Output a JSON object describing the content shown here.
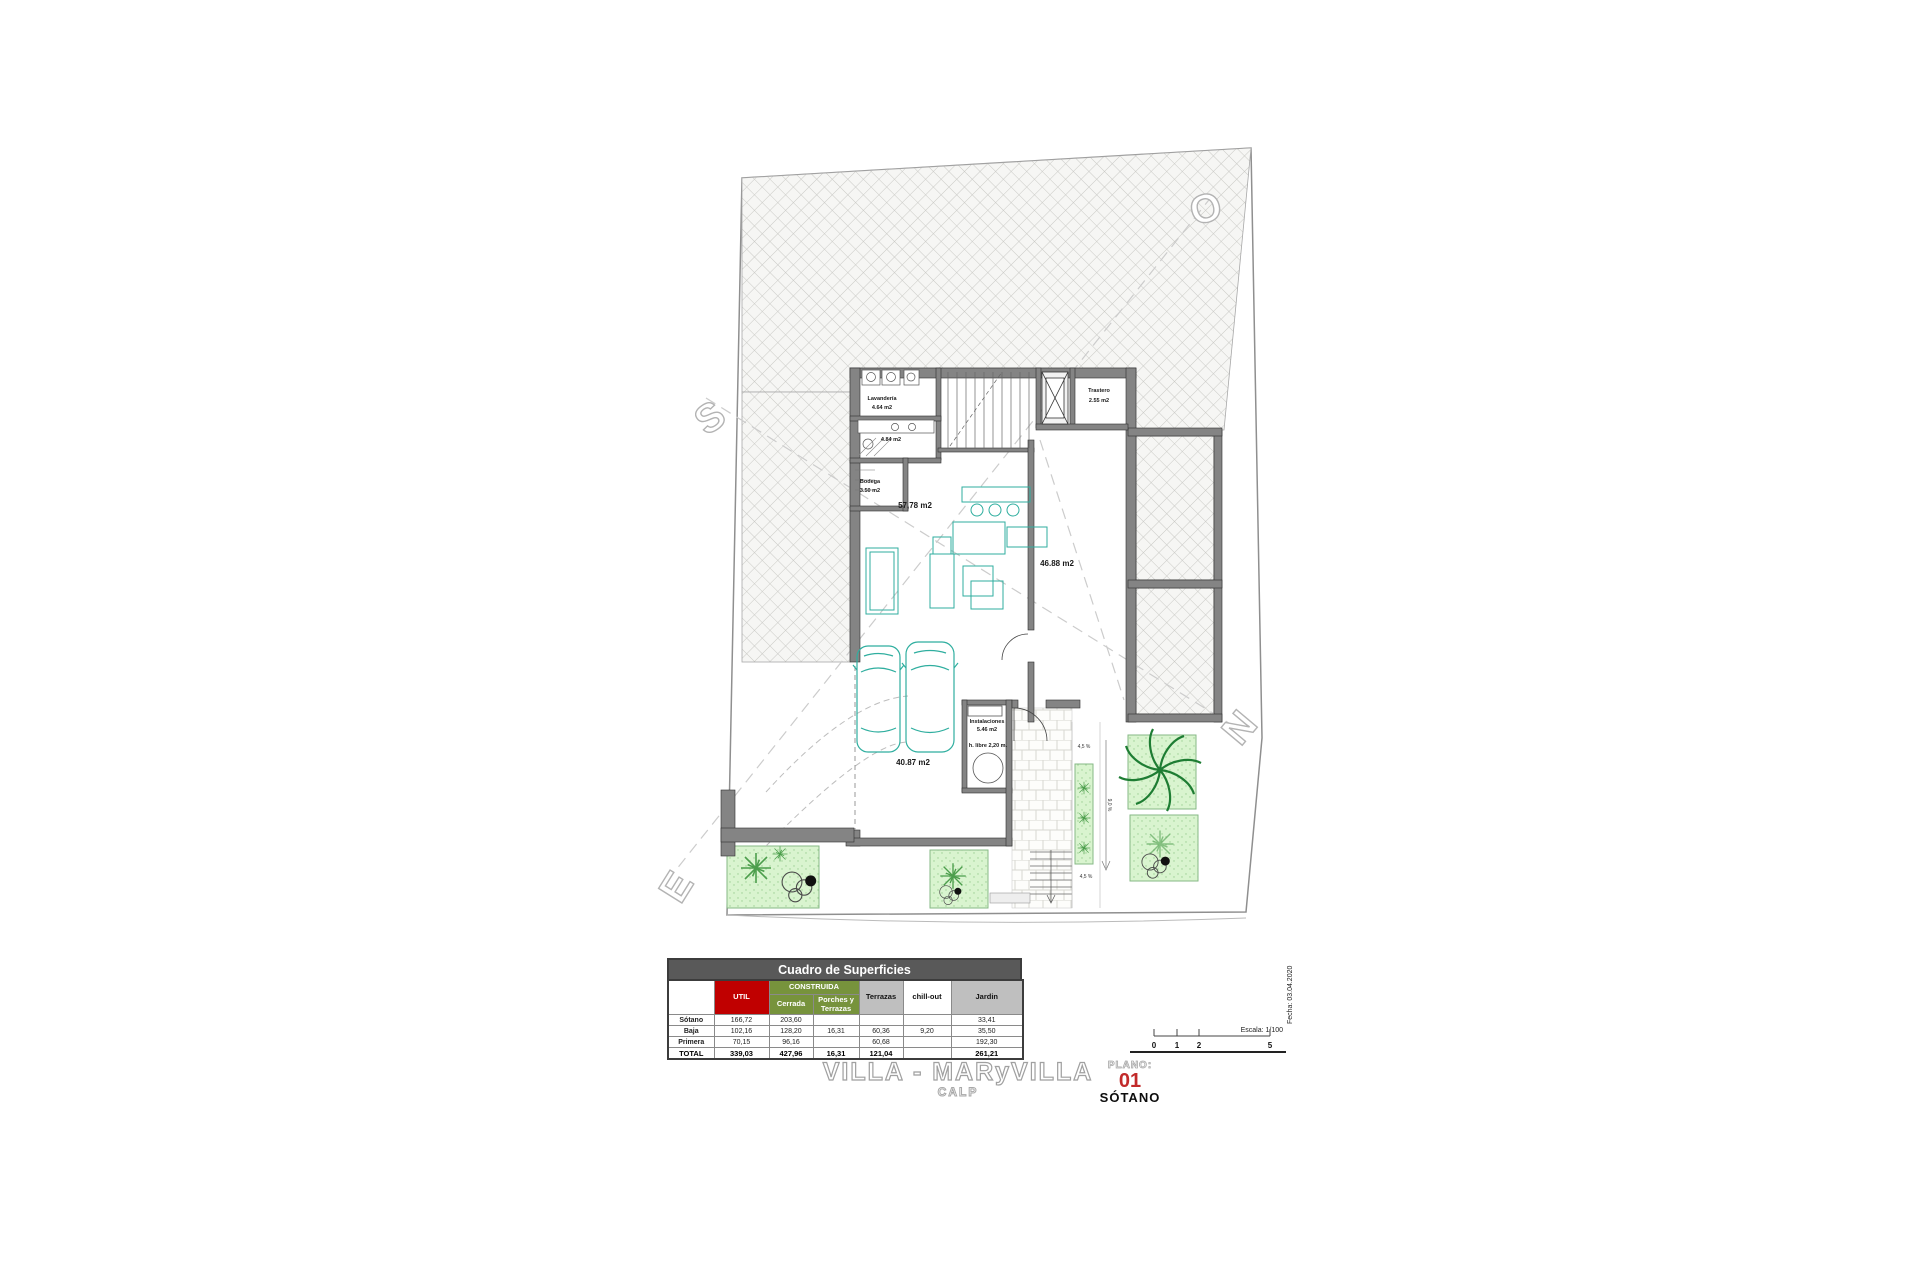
{
  "colors": {
    "accent_red": "#c00000",
    "accent_green": "#77933c",
    "header_dark_gray": "#595959",
    "header_light_gray": "#bfbfbf",
    "furniture_teal": "#2fae9f",
    "garden_green": "#d9f4cf",
    "plano_number_red": "#c22a2a"
  },
  "surfaces": {
    "title": "Cuadro de Superficies",
    "headers": {
      "util": "UTIL",
      "construida": "CONSTRUIDA",
      "cerrada": "Cerrada",
      "porches": "Porches y Terrazas",
      "terrazas": "Terrazas",
      "chill_out": "chill-out",
      "jardin": "Jardin"
    },
    "rows": [
      {
        "label": "Sótano",
        "cells": [
          "166,72",
          "203,60",
          "",
          "",
          "",
          "33,41"
        ]
      },
      {
        "label": "Baja",
        "cells": [
          "102,16",
          "128,20",
          "16,31",
          "60,36",
          "9,20",
          "35,50"
        ]
      },
      {
        "label": "Primera",
        "cells": [
          "70,15",
          "96,16",
          "",
          "60,68",
          "",
          "192,30"
        ]
      },
      {
        "label": "TOTAL",
        "cells": [
          "339,03",
          "427,96",
          "16,31",
          "121,04",
          "",
          "261,21"
        ]
      }
    ]
  },
  "title_block": {
    "project": "VILLA - MARyVILLA",
    "location": "CALP",
    "plano_label": "PLANO:",
    "plano_number": "01",
    "plano_name": "SÓTANO"
  },
  "scale_bar": {
    "ticks": [
      "0",
      "1",
      "2",
      "5"
    ],
    "escala": "Escala: 1/100",
    "fecha": "Fecha: 03.04.2020"
  },
  "plan": {
    "rooms": {
      "lavanderia_name": "Lavandería",
      "lavanderia_area": "4.64 m2",
      "bano_area": "4.84 m2",
      "trastero_name": "Trastero",
      "trastero_area": "2.55 m2",
      "bodega_name": "Bodega",
      "bodega_area": "3.50 m2",
      "salon_area": "57,78 m2",
      "este_area": "46.88 m2",
      "garaje_area": "40.87 m2",
      "instalaciones_name": "Instalaciones",
      "instalaciones_area": "5.46 m2",
      "altura_libre": "h. libre 2,20 m.",
      "rampa_sup": "4,5 %",
      "rampa_inf": "4,5 %",
      "rampa_lateral": "9,0 %"
    },
    "compass": {
      "norte": "N",
      "sur": "S",
      "este": "E",
      "oeste": "O"
    }
  }
}
